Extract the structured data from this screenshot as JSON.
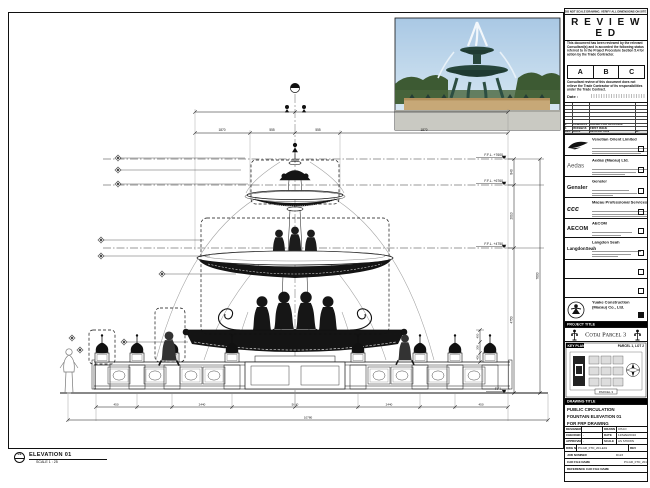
{
  "stamp": {
    "note": "DO NOT SCALE DRAWING. VERIFY ALL DIMENSIONS ON SITE BEFORE COMMENCING WORK.",
    "title": "R E V I E W E D",
    "para1": "This document has been reviewed by the relevant Consultant(s) and is accorded the following status referred to in the Project Procedure Section 5.4 for action by the Trade Contractor.",
    "statuses": [
      "A",
      "B",
      "C"
    ],
    "para2": "Consultant review of this document does not relieve the Trade Contractor of its responsibilities under the Trade Contract.",
    "date_label": "Date :"
  },
  "revisions": {
    "rows": [
      {
        "rev": "2",
        "date": "12/MAR/16",
        "desc": "ISSUED FOR APPROVAL"
      },
      {
        "rev": "1",
        "date": "05/FEB/16",
        "desc": "FIRST ISSUE"
      }
    ],
    "header": {
      "rev": "REV",
      "date": "DATE",
      "desc": "DESCRIPTION",
      "by": "BY"
    }
  },
  "consultants": [
    {
      "logo": "",
      "name": "Venetian Orient Limited"
    },
    {
      "logo": "Aedas",
      "name": "Aedas (Macau) Ltd."
    },
    {
      "logo": "Gensler",
      "name": "Gensler"
    },
    {
      "logo": "ccc",
      "name": "Macau Professional Services Ltd."
    },
    {
      "logo": "AECOM",
      "name": "AECOM"
    },
    {
      "logo": "LangdonSeah",
      "name": "Langdon Seah"
    },
    {
      "logo": "",
      "name": ""
    },
    {
      "logo": "",
      "name": ""
    },
    {
      "logo": "",
      "name": "Yuake Construction (Macau) Co., Ltd."
    }
  ],
  "project": {
    "bar": "PROJECT TITLE",
    "title": "Cotai Parcel 3"
  },
  "key_plan": {
    "bar": "KEY PLAN",
    "parcel": "PARCEL 1, LOT 2",
    "caption": "PARCEL 3"
  },
  "drawing_title": {
    "bar": "DRAWING TITLE",
    "line1": "PUBLIC CIRCULATION",
    "line2": "FOUNTAIN ELEVATION 01",
    "line3": "FOR FRP DRAWING"
  },
  "info": {
    "designed_label": "DESIGNED",
    "designed": "",
    "drawn_label": "DRAWN",
    "drawn": "CHAO",
    "checked_label": "CHECKED",
    "checked": "-",
    "date_label": "DATE",
    "date": "12/MAR/2016",
    "approved_label": "APPROVED",
    "approved": "-",
    "scale_label": "SCALE",
    "scale": "AS SHOWN",
    "dwg_label": "DWG NO.",
    "dwg_no": "P3-GR_FTD_201-E01",
    "rev_label": "REV",
    "rev": "B",
    "job_label": "JOB NUMBER",
    "job": "D123",
    "cad_label": "CAD FILE NAME",
    "cad": "P3-GR_FTD_201-E01.dwg",
    "ref_label": "REFERENCE CAD FILE NAME",
    "ref": ""
  },
  "elevation_callout": {
    "number": "01",
    "title": "ELEVATION 01",
    "scale": "SCALE  1 : 25"
  },
  "levels": [
    "F.F.L. +7600",
    "F.F.L. +6760",
    "F.F.L. +4750",
    "F.F.L."
  ],
  "dims": {
    "top": [
      "1870",
      "555",
      "555",
      "1870"
    ],
    "right": [
      "840",
      "2010",
      "4750"
    ],
    "right_total": "7600",
    "bottom": [
      "450",
      "2440",
      "5000",
      "2440",
      "450"
    ],
    "bottom_total": "10780",
    "urn": [
      "450",
      "300",
      "400"
    ]
  }
}
